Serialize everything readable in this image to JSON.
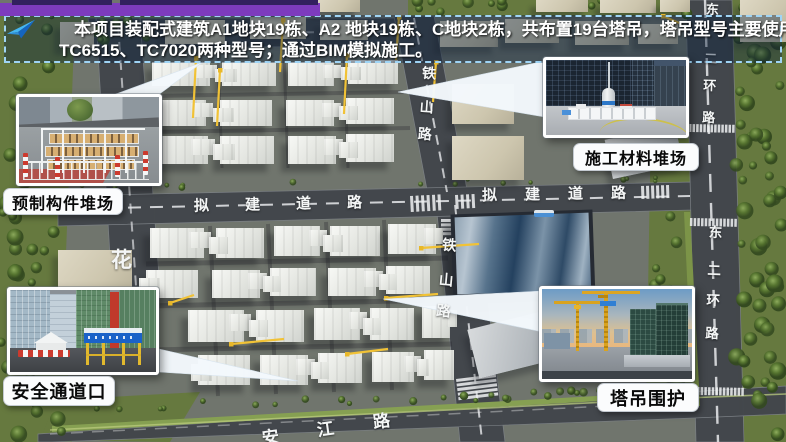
{
  "slide": {
    "top_bar_color": "#7d3bbd",
    "banner": {
      "line1": "本项目装配式建筑A1地块19栋、A2 地块19栋、C地块2栋，共布置19台塔吊，塔吊型号主要使用",
      "line2": "TC6515、TC7020两种型号；通过BIM模拟施工。"
    }
  },
  "callouts": {
    "prefab_yard": "预制构件堆场",
    "material_yard": "施工材料堆场",
    "safety_passage": "安全通道口",
    "crane_fence": "塔吊围护"
  },
  "map_labels": {
    "tieshan_upper": [
      "铁",
      "山",
      "路"
    ],
    "tieshan_lower": [
      "铁",
      "山",
      "路"
    ],
    "nijian_left": [
      "拟",
      "建",
      "道",
      "路"
    ],
    "nijian_right": [
      "拟",
      "建",
      "道",
      "路"
    ],
    "donger_upper": [
      "东",
      "二",
      "环",
      "路"
    ],
    "donger_lower": [
      "东",
      "二",
      "环",
      "路"
    ],
    "hua_road": "花",
    "anjiang_road": [
      "安",
      "江",
      "路"
    ]
  },
  "colors": {
    "crane_yellow": "#f1c236",
    "banner_border": "#9fd4f5",
    "road_gray": "#43474c",
    "vegetation_green": "#66793f"
  }
}
